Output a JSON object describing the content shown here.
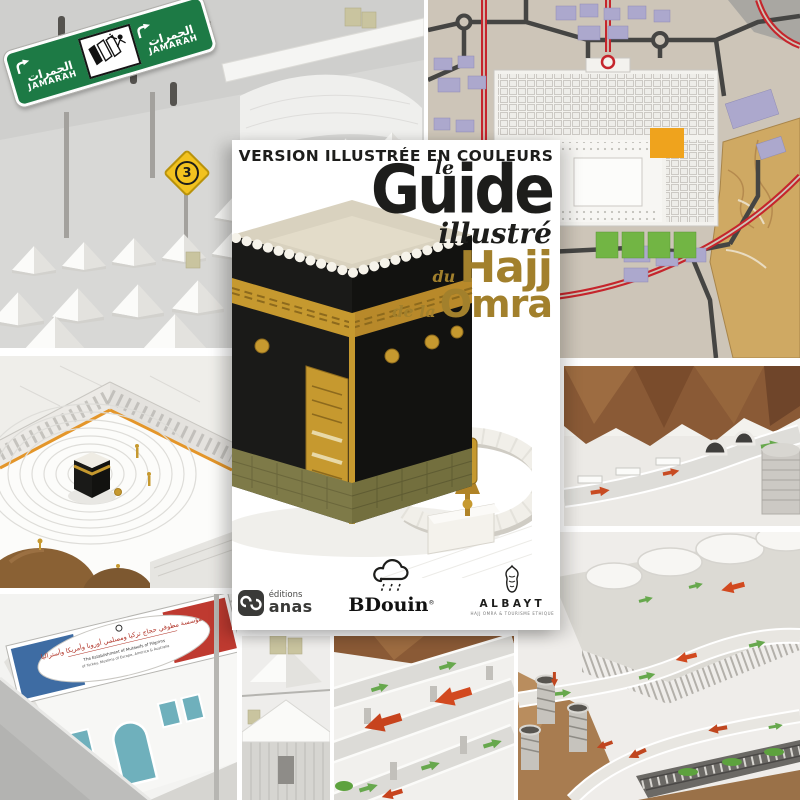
{
  "cover": {
    "banner": "VERSION ILLUSTRÉE EN COULEURS",
    "title": {
      "article": "le",
      "main": "Guide",
      "sub": "illustré",
      "prefix_hajj": "du",
      "hajj": "Hajj",
      "prefix_omra": "de la",
      "omra": "Omra"
    },
    "publishers": {
      "anas": {
        "line1": "éditions",
        "line2": "anas"
      },
      "bdouin": {
        "name": "BDouin",
        "reg": "®"
      },
      "albayt": {
        "name": "ALBAYT",
        "tagline": "HAJJ OMRA & TOURISME ETHIQUE"
      }
    }
  },
  "signs": {
    "jamarah": {
      "arabic": "الجمرات",
      "latin": "JAMARAH"
    },
    "route_number": "3"
  },
  "street_banner": {
    "arabic": "مؤسسة مطوفي حجاج تركيا ومسلمي أوروبا وأمريكا وأستراليا",
    "english_line1": "The Establishment of Mutawifs of Pilgrims",
    "english_line2": "of Turkey, Muslims of Europe, America & Australia"
  },
  "palette": {
    "cover_gold": "#a2802c",
    "cover_ink": "#1d1d1b",
    "sign_green": "#1d7a45",
    "route_sign_yellow": "#f2c21f",
    "map_red": "#c5252c",
    "map_building_purple": "#aca8cd",
    "map_ground": "#cdc5b8",
    "arrow_green": "#67a84d",
    "arrow_red": "#cc4a1e",
    "mountain_brown": "#8a5a36",
    "kiswa_black": "#1a1a18",
    "kiswa_gold": "#c6992f"
  },
  "icons": {
    "bdouin": "cloud-rain-icon",
    "anas": "editions-anas-monogram-icon",
    "albayt": "albayt-emblem-icon",
    "jamarah_pictogram": "jamarat-stoning-pictogram-icon",
    "jamarah_arrow": "curve-right-arrow-icon"
  }
}
